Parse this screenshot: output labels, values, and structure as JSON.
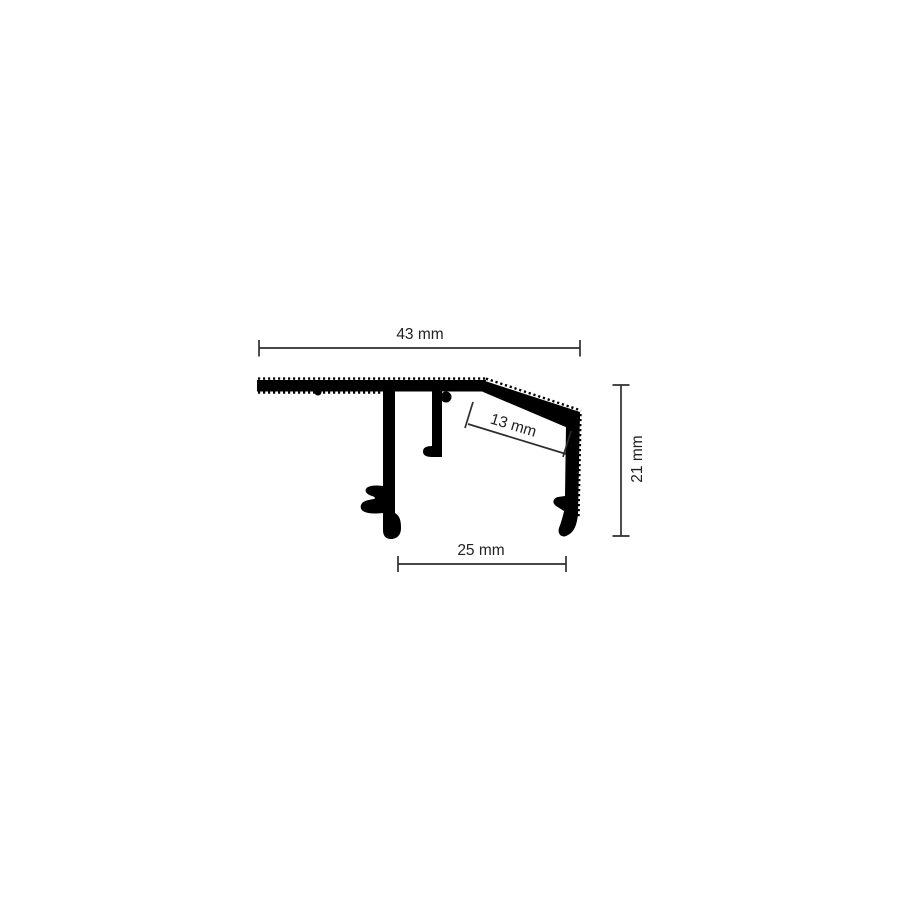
{
  "drawing": {
    "colors": {
      "profile": "#000000",
      "dimension": "#2e2e2e",
      "background": "#ffffff"
    },
    "dimensions": {
      "total_width": {
        "value": 43,
        "unit": "mm",
        "label": "43 mm"
      },
      "inner_slope": {
        "value": 13,
        "unit": "mm",
        "label": "13 mm"
      },
      "height": {
        "value": 21,
        "unit": "mm",
        "label": "21 mm"
      },
      "base_width": {
        "value": 25,
        "unit": "mm",
        "label": "25 mm"
      }
    }
  }
}
